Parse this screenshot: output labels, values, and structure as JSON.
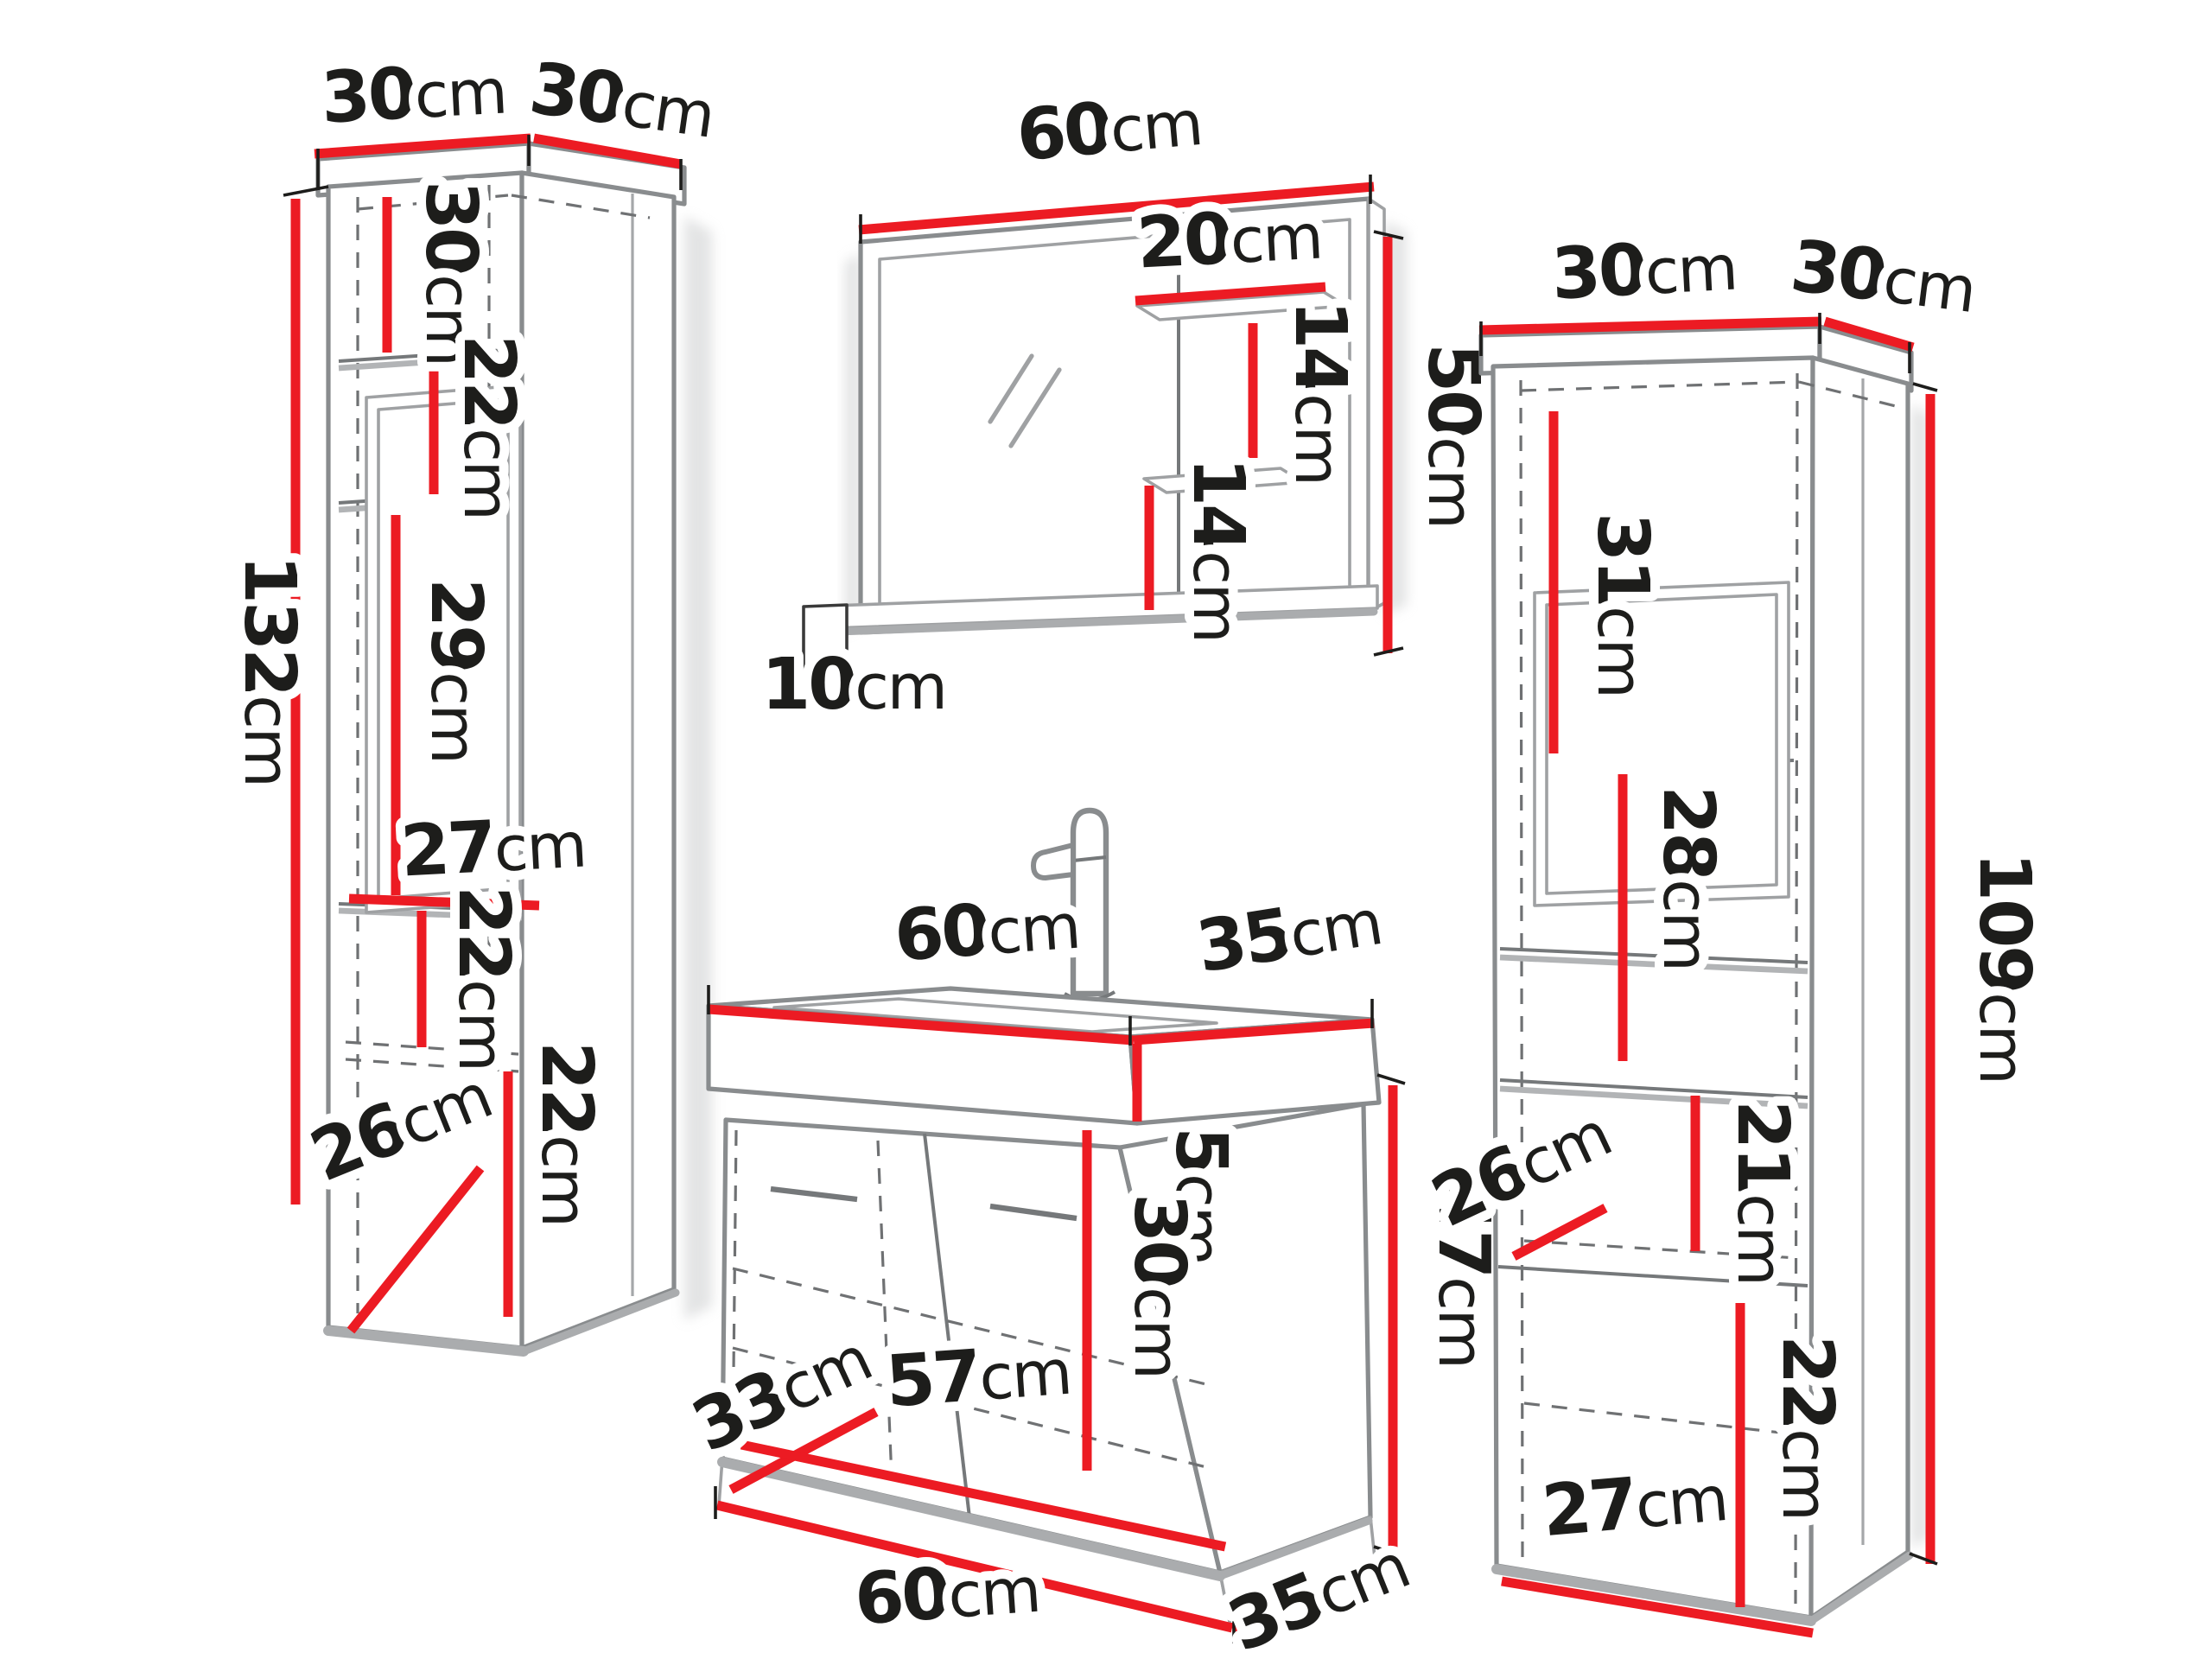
{
  "title": "Bathroom furniture set dimension diagram",
  "unit": "cm",
  "colors": {
    "dimension_red": "#ec1b23",
    "outline_gray": "#898c8e",
    "shadow_gray": "#aaacae",
    "text_black": "#1d1d1b",
    "background": "#ffffff"
  },
  "furniture": {
    "left_tall_cabinet": {
      "height_cm": 132,
      "top_width_cm": 30,
      "top_depth_cm": 30,
      "shelf_sections_cm": [
        30,
        22,
        29,
        22,
        22
      ],
      "inner_width_cm": 27,
      "bottom_inner_depth_cm": 26
    },
    "mirror_cabinet": {
      "width_cm": 60,
      "height_cm": 50,
      "side_shelf_width_cm": 20,
      "shelf_gaps_cm": [
        14,
        14
      ],
      "bottom_shelf_depth_cm": 10
    },
    "sink_vanity": {
      "width_cm": 60,
      "depth_cm": 35,
      "body_height_cm": 47,
      "basin_height_cm": 5,
      "inner_height_cm": 30,
      "inner_width_cm": 57,
      "inner_depth_cm": 33,
      "base_width_cm": 60,
      "base_depth_cm": 35
    },
    "right_tall_cabinet": {
      "height_cm": 109,
      "top_width_cm": 30,
      "top_depth_cm": 30,
      "shelf_sections_cm": [
        31,
        28,
        21,
        22
      ],
      "bottom_inner_width_cm": 27,
      "bottom_inner_depth_cm": 26
    }
  },
  "labels": {
    "lc_top_w": {
      "v": "30",
      "u": "cm"
    },
    "lc_top_d": {
      "v": "30",
      "u": "cm"
    },
    "lc_s1": {
      "v": "30",
      "u": "cm"
    },
    "lc_s2": {
      "v": "22",
      "u": "cm"
    },
    "lc_s3": {
      "v": "29",
      "u": "cm"
    },
    "lc_w": {
      "v": "27",
      "u": "cm"
    },
    "lc_s4": {
      "v": "22",
      "u": "cm"
    },
    "lc_d": {
      "v": "26",
      "u": "cm"
    },
    "lc_s5": {
      "v": "22",
      "u": "cm"
    },
    "lc_h": {
      "v": "132",
      "u": "cm"
    },
    "mr_w": {
      "v": "60",
      "u": "cm"
    },
    "mr_shelf": {
      "v": "20",
      "u": "cm"
    },
    "mr_gap1": {
      "v": "14",
      "u": "cm"
    },
    "mr_h": {
      "v": "50",
      "u": "cm"
    },
    "mr_gap2": {
      "v": "14",
      "u": "cm"
    },
    "mr_d": {
      "v": "10",
      "u": "cm"
    },
    "vn_w": {
      "v": "60",
      "u": "cm"
    },
    "vn_d": {
      "v": "35",
      "u": "cm"
    },
    "vn_basin": {
      "v": "5",
      "u": "cm"
    },
    "vn_h": {
      "v": "47",
      "u": "cm"
    },
    "vn_inner": {
      "v": "30",
      "u": "cm"
    },
    "vn_id": {
      "v": "33",
      "u": "cm"
    },
    "vn_iw": {
      "v": "57",
      "u": "cm"
    },
    "vn_bw": {
      "v": "60",
      "u": "cm"
    },
    "vn_bd": {
      "v": "35",
      "u": "cm"
    },
    "rc_tw": {
      "v": "30",
      "u": "cm"
    },
    "rc_td": {
      "v": "30",
      "u": "cm"
    },
    "rc_s1": {
      "v": "31",
      "u": "cm"
    },
    "rc_s2": {
      "v": "28",
      "u": "cm"
    },
    "rc_h": {
      "v": "109",
      "u": "cm"
    },
    "rc_s3": {
      "v": "21",
      "u": "cm"
    },
    "rc_d": {
      "v": "26",
      "u": "cm"
    },
    "rc_s4": {
      "v": "22",
      "u": "cm"
    },
    "rc_bw": {
      "v": "27",
      "u": "cm"
    }
  }
}
